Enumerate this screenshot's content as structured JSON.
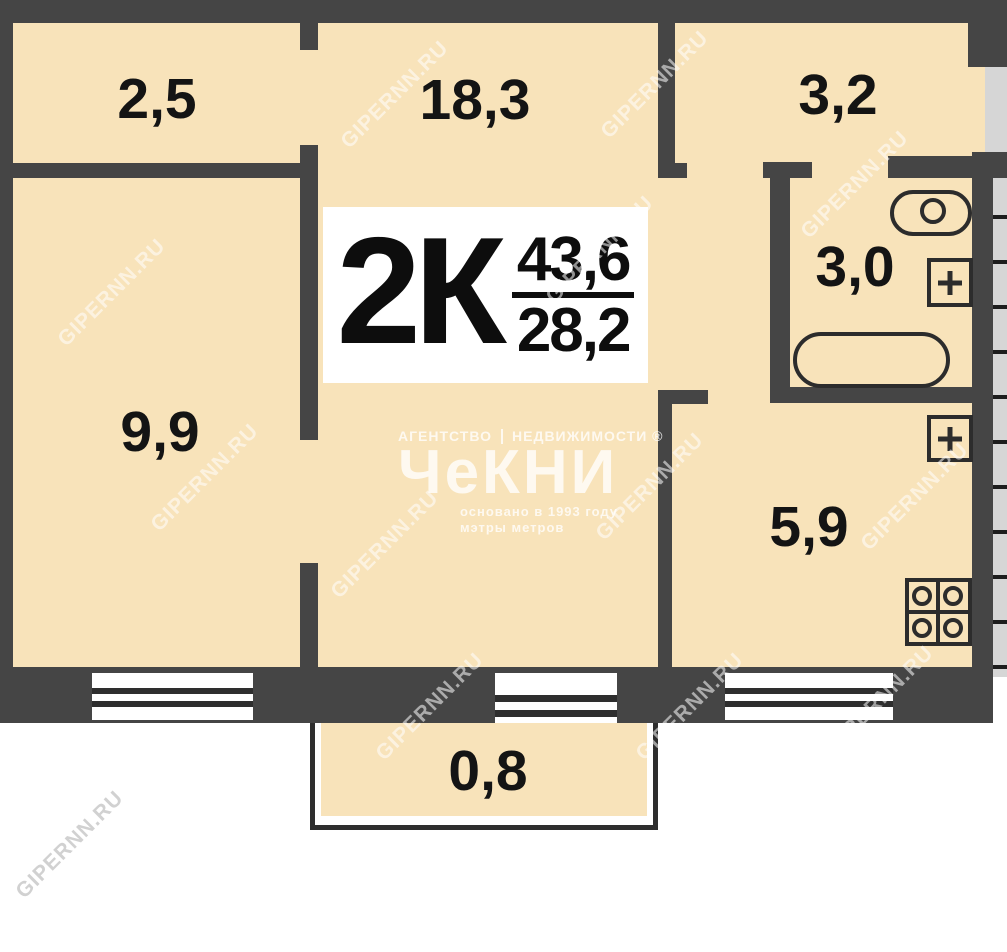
{
  "plan": {
    "type_label": "2К",
    "area_total": "43,6",
    "area_living": "28,2"
  },
  "rooms": {
    "storage": "2,5",
    "living": "18,3",
    "hallway": "3,2",
    "bedroom": "9,9",
    "bathroom": "3,0",
    "kitchen": "5,9",
    "balcony": "0,8"
  },
  "logo": {
    "line1a": "АГЕНТСТВО",
    "line1b": "НЕДВИЖИМОСТИ ®",
    "name": "ЧеКНИ",
    "line2": "основано в 1993 году",
    "line3": "мэтры метров"
  },
  "watermark": "GIPERNN.RU",
  "colors": {
    "wall": "#454545",
    "room_fill": "#f8e3ba",
    "shaft": "#d6d6d6",
    "label_text": "#141414"
  }
}
